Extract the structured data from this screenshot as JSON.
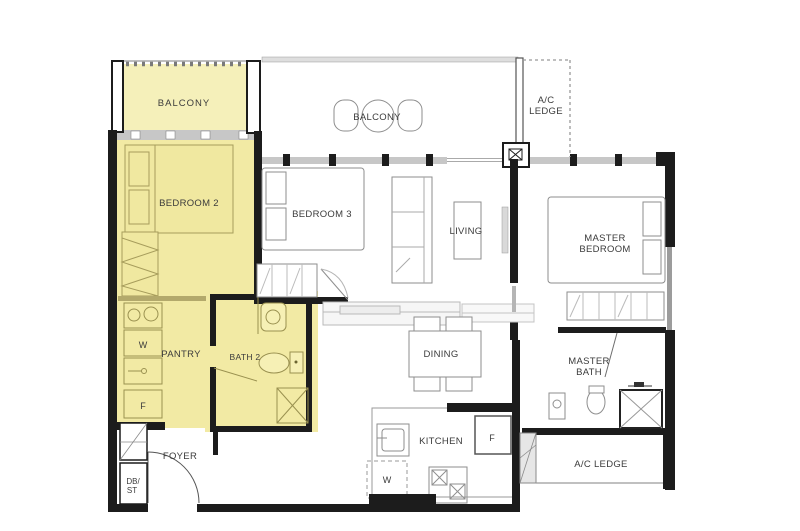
{
  "colors": {
    "highlight": "#F2EAA4",
    "highlight_balcony": "#F5F0BA",
    "wall": "#1C1C1C",
    "label": "#3B3B3B",
    "balcony_label": "#96927C"
  },
  "rooms": {
    "balcony_top": {
      "label": "BALCONY"
    },
    "balcony_mid": {
      "label": "BALCONY"
    },
    "ac_ledge_top": {
      "line1": "A/C",
      "line2": "LEDGE"
    },
    "bedroom2": {
      "label": "BEDROOM 2"
    },
    "bedroom3": {
      "label": "BEDROOM 3"
    },
    "living": {
      "label": "LIVING"
    },
    "master_bedroom": {
      "line1": "MASTER",
      "line2": "BEDROOM"
    },
    "pantry": {
      "label": "PANTRY"
    },
    "bath2": {
      "label": "BATH 2"
    },
    "dining": {
      "label": "DINING"
    },
    "master_bath": {
      "line1": "MASTER",
      "line2": "BATH"
    },
    "kitchen": {
      "label": "KITCHEN"
    },
    "foyer": {
      "label": "FOYER"
    },
    "ac_ledge_bottom": {
      "label": "A/C LEDGE"
    },
    "db_st": {
      "line1": "DB/",
      "line2": "ST"
    }
  },
  "appliances": {
    "pantry_washer": "W",
    "pantry_fridge": "F",
    "kitchen_washer": "W",
    "kitchen_fridge": "F"
  }
}
